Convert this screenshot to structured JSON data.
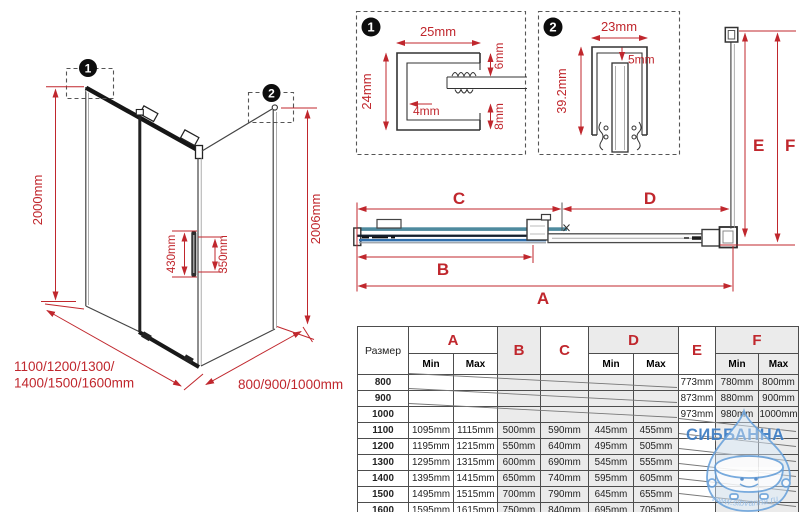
{
  "colors": {
    "red": "#c0272d",
    "teal": "#4e8a9e",
    "blue": "#2f6fad",
    "watermark_blue": "#3c7cc3"
  },
  "iso": {
    "callout1": "1",
    "callout2": "2",
    "dim_height_left": "2000mm",
    "dim_height_right": "2006mm",
    "dim_handle_length": "430mm",
    "dim_handle_holes": "350mm",
    "width_label_line1": "1100/1200/1300/",
    "width_label_line2": "1400/1500/1600mm",
    "depth_label": "800/900/1000mm"
  },
  "detail1": {
    "badge": "1",
    "dim_top": "25mm",
    "dim_left": "24mm",
    "dim_right_top": "6mm",
    "dim_inner": "4mm",
    "dim_right_bottom": "8mm"
  },
  "detail2": {
    "badge": "2",
    "dim_top": "23mm",
    "dim_left": "39.2mm",
    "dim_inner": "5mm"
  },
  "plan": {
    "labels": {
      "A": "A",
      "B": "B",
      "C": "C",
      "D": "D",
      "E": "E",
      "F": "F"
    }
  },
  "table": {
    "size_header": "Размер",
    "min_label": "Min",
    "max_label": "Max",
    "groups": [
      "A",
      "B",
      "C",
      "D",
      "E",
      "F"
    ],
    "rows": [
      [
        "800",
        "",
        "",
        "",
        "",
        "",
        "",
        "773mm",
        "780mm",
        "800mm"
      ],
      [
        "900",
        "",
        "",
        "",
        "",
        "",
        "",
        "873mm",
        "880mm",
        "900mm"
      ],
      [
        "1000",
        "",
        "",
        "",
        "",
        "",
        "",
        "973mm",
        "980mm",
        "1000mm"
      ],
      [
        "1100",
        "1095mm",
        "1115mm",
        "500mm",
        "590mm",
        "445mm",
        "455mm",
        "",
        "",
        ""
      ],
      [
        "1200",
        "1195mm",
        "1215mm",
        "550mm",
        "640mm",
        "495mm",
        "505mm",
        "",
        "",
        ""
      ],
      [
        "1300",
        "1295mm",
        "1315mm",
        "600mm",
        "690mm",
        "545mm",
        "555mm",
        "",
        "",
        ""
      ],
      [
        "1400",
        "1395mm",
        "1415mm",
        "650mm",
        "740mm",
        "595mm",
        "605mm",
        "",
        "",
        ""
      ],
      [
        "1500",
        "1495mm",
        "1515mm",
        "700mm",
        "790mm",
        "645mm",
        "655mm",
        "",
        "",
        ""
      ],
      [
        "1600",
        "1595mm",
        "1615mm",
        "750mm",
        "840mm",
        "695mm",
        "705mm",
        "",
        "",
        ""
      ]
    ]
  },
  "watermark": {
    "name": "СИББАННА",
    "url": "www.sibvanna.ru"
  }
}
